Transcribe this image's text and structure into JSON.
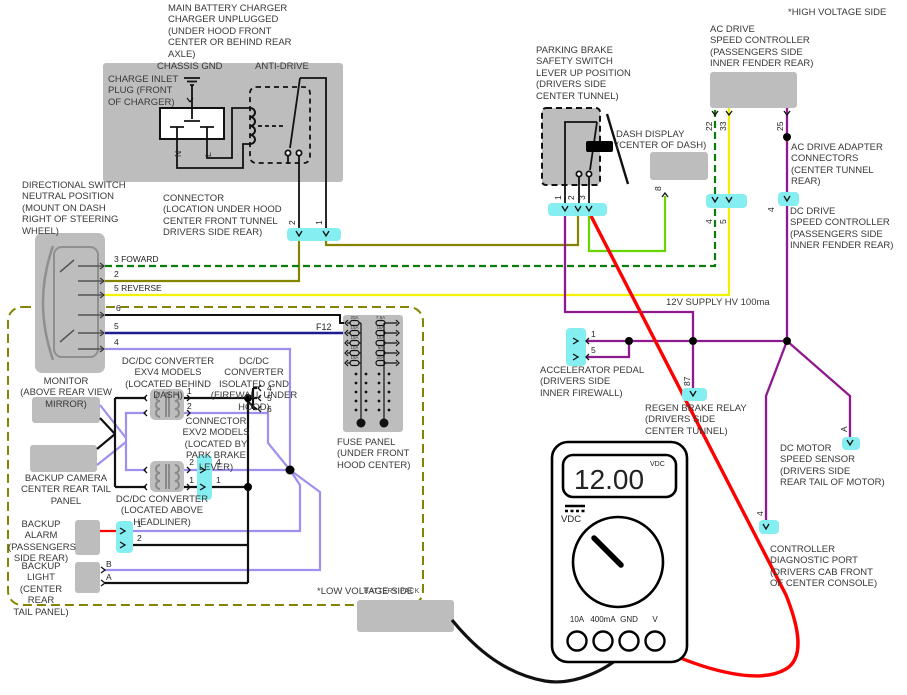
{
  "titles": {
    "hv_side": "*HIGH VOLTAGE SIDE",
    "lv_side": "*LOW VOLTAGE SIDE"
  },
  "charger": {
    "label": "MAIN BATTERY CHARGER\nCHARGER UNPLUGGED\n(UNDER HOOD FRONT\nCENTER OR BEHIND REAR\nAXLE)",
    "chassis_gnd": "CHASSIS GND",
    "inlet": "CHARGE INLET\nPLUG (FRONT\nOF CHARGER)",
    "anti_drive": "ANTI-DRIVE",
    "pin_n": "N",
    "pin_l": "L"
  },
  "hood_connector": {
    "label": "CONNECTOR\n(LOCATION UNDER HOOD\nCENTER FRONT TUNNEL\nDRIVERS SIDE REAR)",
    "pin2": "2",
    "pin1": "1"
  },
  "directional": {
    "label": "DIRECTIONAL SWITCH\nNEUTRAL POSITION\n(MOUNT ON DASH\nRIGHT OF STEERING\nWHEEL)",
    "row_forward": "3  FOWARD",
    "row_2": "2",
    "row_reverse": "5  REVERSE",
    "row_6": "6",
    "row_5": "5",
    "row_4": "4"
  },
  "parking_brake": {
    "label": "PARKING BRAKE\nSAFETY SWITCH\nLEVER UP POSITION\n(DRIVERS SIDE\nCENTER TUNNEL)",
    "pin1": "1",
    "pin2": "2",
    "pin3": "3"
  },
  "dash_display": {
    "label": "DASH DISPLAY\n(CENTER OF DASH)",
    "pin": "8"
  },
  "ac_controller": {
    "label": "AC DRIVE\nSPEED CONTROLLER\n(PASSENGERS SIDE\nINNER FENDER REAR)",
    "w22": "22",
    "w33": "33",
    "w25": "25"
  },
  "ac_adapter": {
    "label": "AC DRIVE ADAPTER\nCONNECTORS\n(CENTER TUNNEL\nREAR)",
    "pin4": "4",
    "pin5": "5"
  },
  "dc_controller": {
    "label": "DC DRIVE\nSPEED CONTROLLER\n(PASSENGERS SIDE\nINNER FENDER REAR)",
    "pin4": "4"
  },
  "supply": {
    "label": "12V SUPPLY HV 100ma"
  },
  "accelerator": {
    "label": "ACCELERATOR PEDAL\n(DRIVERS SIDE\nINNER FIREWALL)",
    "pin1": "1",
    "pin5": "5"
  },
  "regen": {
    "label": "REGEN BRAKE RELAY\n(DRIVERS SIDE\nCENTER TUNNEL)",
    "pin": "87"
  },
  "speed_sensor": {
    "label": "DC MOTOR\nSPEED SENSOR\n(DRIVERS SIDE\nREAR TAIL OF MOTOR)",
    "pin": "A"
  },
  "diag_port": {
    "label": "CONTROLLER\nDIAGNOSTIC PORT\n(DRIVERS CAB FRONT\nOF CENTER CONSOLE)",
    "pin": "4"
  },
  "fuse_panel": {
    "tag": "F12",
    "label": "FUSE PANEL\n(UNDER FRONT\nHOOD CENTER)",
    "left_amps": [
      "20A",
      "15A",
      "15A",
      "10A",
      "15A"
    ],
    "right_amps": [
      "7.5A",
      "15A",
      "15A",
      "5A",
      "20A"
    ]
  },
  "converters": {
    "exv4": {
      "label": "DC/DC CONVERTER\nEXV4 MODELS\n(LOCATED BEHIND DASH)",
      "pin1": "1",
      "pin2": "2"
    },
    "isolated": {
      "label": "DC/DC CONVERTER\nISOLATED GND\n(FIREWALL UNDER\nHOOD)",
      "pin4": "4",
      "pin5": "5",
      "pin6": "6"
    },
    "exv2": {
      "label": "CONNECTOR\nEXV2 MODELS\n(LOCATED BY\nPARK BRAKE\nLEVER)",
      "left_top": "2",
      "right_top": "4",
      "left_bot": "1",
      "right_bot": "1"
    },
    "headliner": {
      "label": "DC/DC CONVERTER\n(LOCATED ABOVE\nHEADLINER)"
    }
  },
  "monitor": {
    "label": "MONITOR\n(ABOVE REAR VIEW MIRROR)"
  },
  "camera": {
    "label": "BACKUP CAMERA\nCENTER REAR TAIL PANEL"
  },
  "alarm": {
    "label": "BACKUP ALARM\n(PASSENGERS\nSIDE REAR)",
    "pin1": "1",
    "pin2": "2"
  },
  "backup_light": {
    "label": "BACKUP LIGHT\n(CENTER REAR\nTAIL PANEL)",
    "pinB": "B",
    "pinA": "A"
  },
  "battery": {
    "label": "BATTERY PACK"
  },
  "meter": {
    "reading": "12.00",
    "display_unit": "VDC",
    "range_label": "VDC",
    "jacks": [
      "10A",
      "400mA",
      "GND",
      "V"
    ]
  },
  "colors": {
    "box_gray": "#bdbdbd",
    "connector_cyan": "#85eef0",
    "olive": "#848400",
    "green_dashed": "#0a7d0a",
    "bright_green": "#66d500",
    "yellow": "#f2f200",
    "navy": "#1c1c8f",
    "lavender": "#9e90ee",
    "purple": "#8f1a8f",
    "red": "#ff0000"
  }
}
